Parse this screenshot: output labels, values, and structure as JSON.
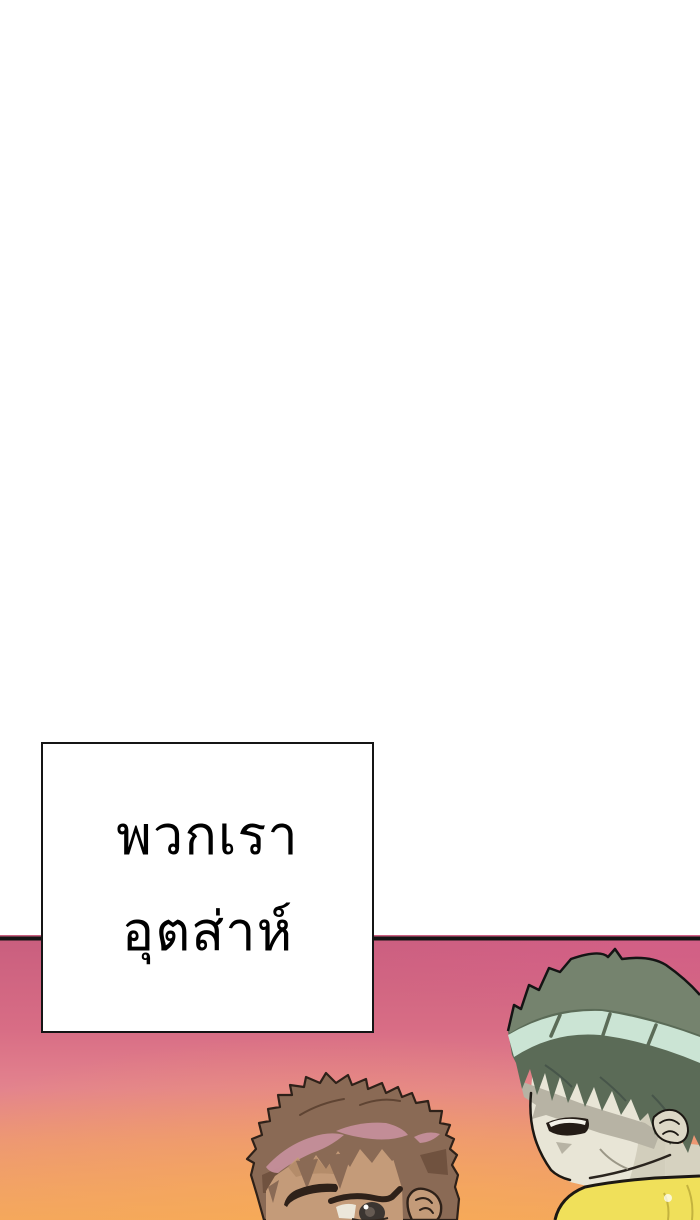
{
  "page": {
    "width": 700,
    "height": 1220,
    "background_color": "#ffffff"
  },
  "speech_bubble": {
    "lines": [
      "พวกเรา",
      "อุตส่าห์"
    ],
    "text_color": "#000000",
    "background_color": "#ffffff",
    "border_color": "#151515"
  },
  "panel": {
    "border_color": "#141414",
    "background_colors": {
      "top_left": "#c85e7e",
      "top_right": "#d9608b",
      "middle_pink": "#e3838e",
      "bottom_orange": "#f4a75e",
      "glow_orange": "#f7ab55"
    },
    "left_character": {
      "hair": "#8a6a55",
      "hair_highlight": "#c58f9b",
      "hair_shadow": "#6b4e3c",
      "outline": "#2e2119",
      "skin": "#c49b79",
      "eye_iris": "#3b3531",
      "eye_white": "#ece7da"
    },
    "right_character": {
      "hair": "#5b6b57",
      "hair_crown": "#75836e",
      "headband": "#cbe4d4",
      "skin": "#e8e5d6",
      "skin_shadow": "#b7b3a4",
      "neck_shadow": "#d6d2c0",
      "mouth": "#241c16",
      "teeth": "#f4f2ea",
      "shirt": "#f0e05a",
      "shirt_fold": "#c4b33e"
    }
  }
}
